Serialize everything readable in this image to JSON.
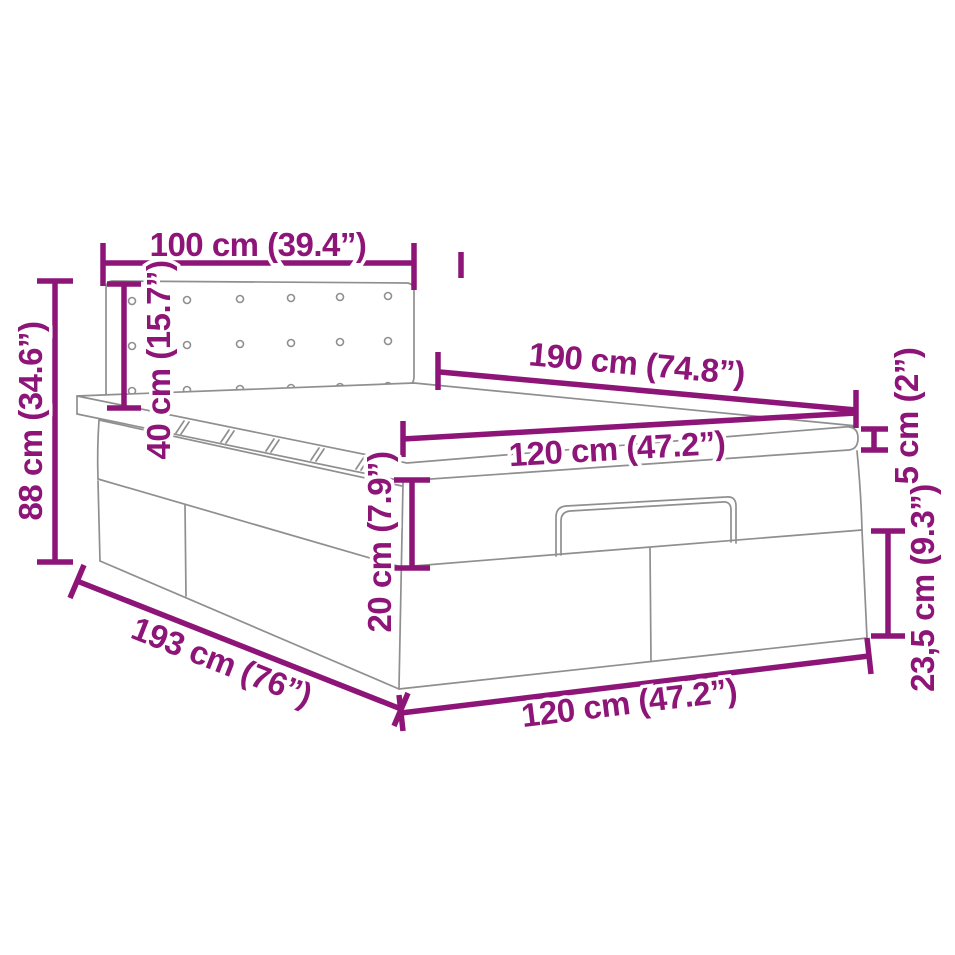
{
  "diagram": {
    "style": {
      "dimension_color": "#8E1578",
      "artwork_line_color": "#8F8F8F",
      "background_color": "#FFFFFF"
    },
    "dimensions": {
      "headboard_width": "100 cm (39.4”)",
      "overall_height": "88 cm (34.6”)",
      "headboard_height": "40 cm (15.7”)",
      "mattress_length": "190 cm (74.8”)",
      "mattress_width": "120 cm (47.2”)",
      "topper_thickness": "5 cm (2”)",
      "upper_frame_height": "20 cm (7.9”)",
      "storage_box_height": "23,5 cm (9.3”)",
      "frame_length": "193 cm (76”)",
      "frame_width": "120 cm (47.2”)"
    }
  }
}
